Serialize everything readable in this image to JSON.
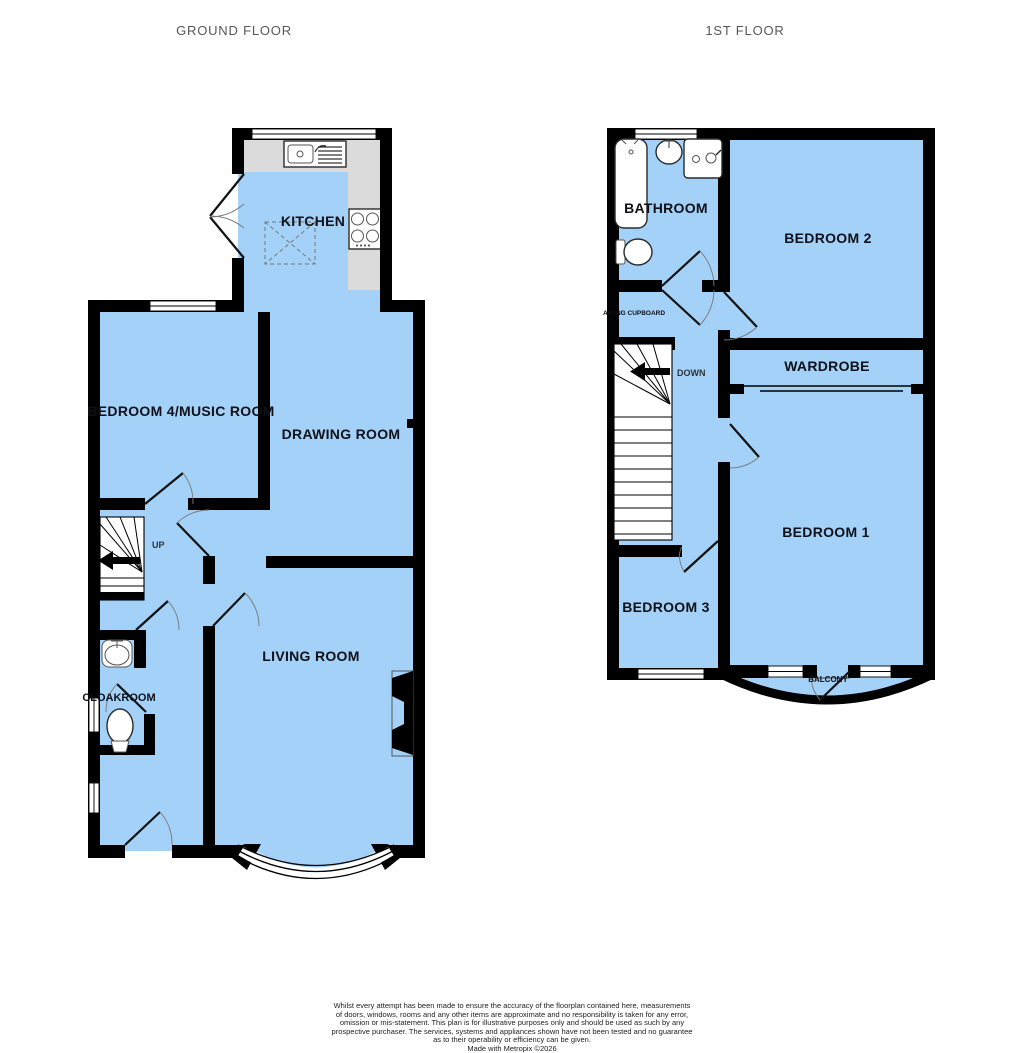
{
  "headers": {
    "ground_floor": "GROUND FLOOR",
    "first_floor": "1ST FLOOR"
  },
  "colors": {
    "room_fill": "#a3d1f7",
    "wall": "#000000",
    "counter": "#dbdbdb",
    "header_text": "#58585a",
    "label_text": "#101018"
  },
  "ground_floor": {
    "rooms": {
      "kitchen": "KITCHEN",
      "bedroom4": "BEDROOM 4/MUSIC ROOM",
      "drawing_room": "DRAWING ROOM",
      "living_room": "LIVING ROOM",
      "cloakroom": "CLOAKROOM"
    },
    "stairs_label": "UP"
  },
  "first_floor": {
    "rooms": {
      "bathroom": "BATHROOM",
      "bedroom2": "BEDROOM 2",
      "airing_cupboard": "AIRING CUPBOARD",
      "wardrobe": "WARDROBE",
      "bedroom1": "BEDROOM 1",
      "bedroom3": "BEDROOM 3",
      "balcony": "BALCONY"
    },
    "stairs_label": "DOWN"
  },
  "footer": {
    "disclaimer_lines": [
      "Whilst every attempt has been made to ensure the accuracy of the floorplan contained here, measurements",
      "of doors, windows, rooms and any other items are approximate and no responsibility is taken for any error,",
      "omission or mis-statement. This plan is for illustrative purposes only and should be used as such by any",
      "prospective purchaser. The services, systems and appliances shown have not been tested and no guarantee",
      "as to their operability or efficiency can be given."
    ],
    "credit": "Made with Metropix ©2026"
  }
}
